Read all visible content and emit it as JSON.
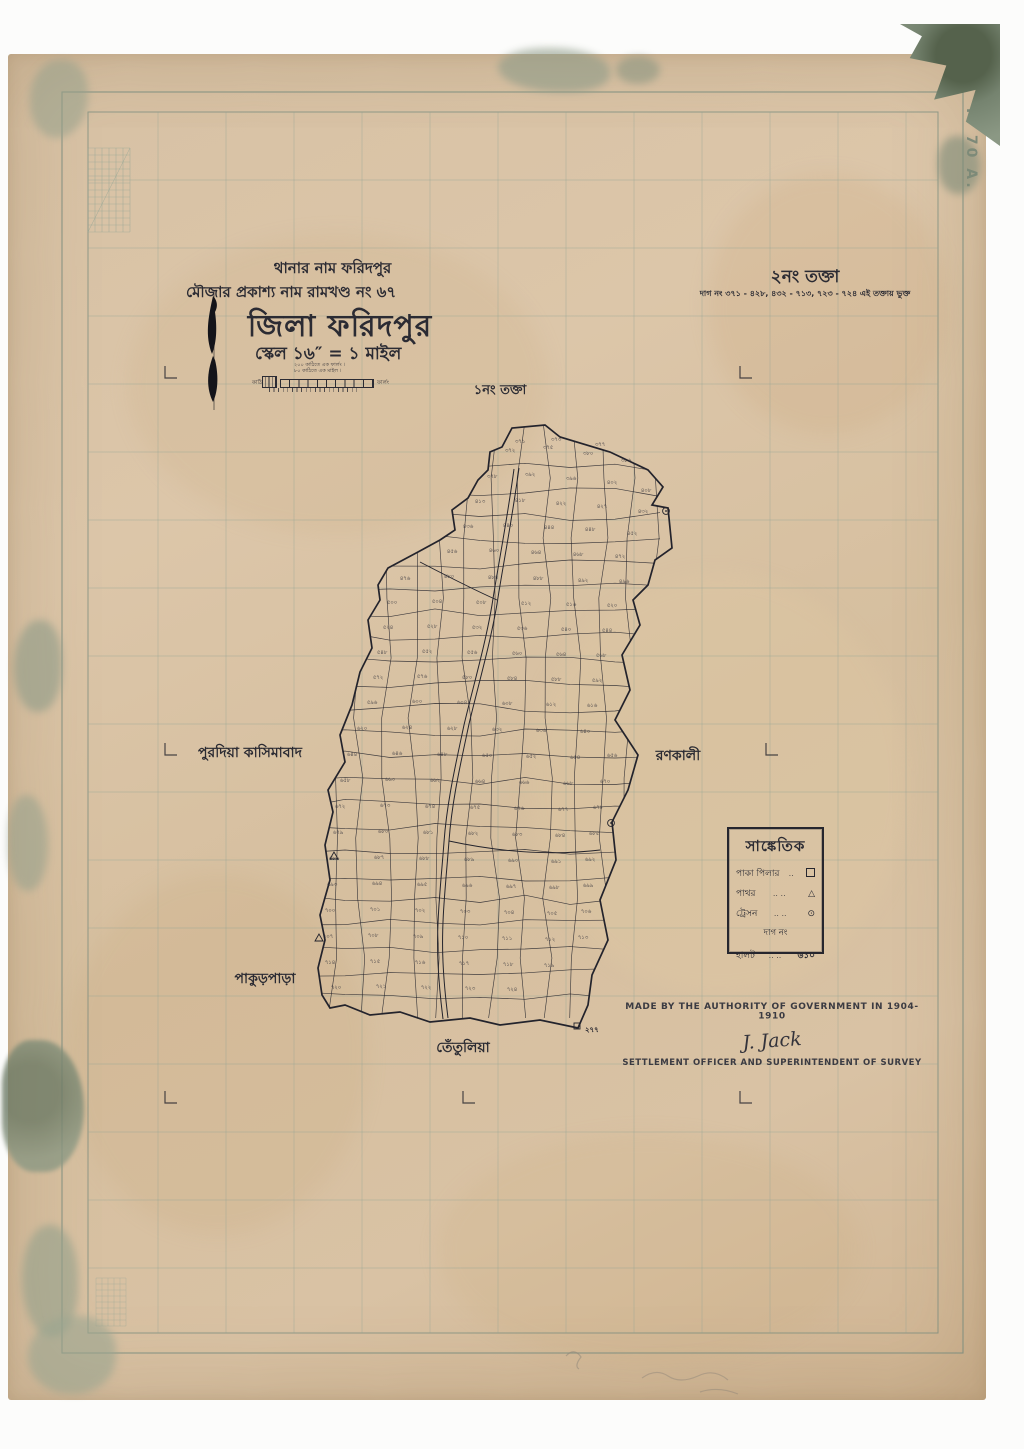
{
  "header": {
    "thana_line": "থানার নাম ফরিদপুর",
    "mouza_line": "মৌজার প্রকাশ্য নাম রামখণ্ড নং ৬৭",
    "district_title": "জিলা ফরিদপুর",
    "scale_line": "স্কেল ১৬″ = ১ মাইল",
    "scale_caption_1": "২০০ কাঠিতে এক ফার্লং ।",
    "scale_caption_2": "৮০ কাঠিতে এক মাইল ।",
    "scale_left_label": "কাঠি",
    "scale_right_label": "ফার্লং"
  },
  "sheet_refs": {
    "this_sheet_title": "২নং তক্তা",
    "this_sheet_plots": "দাগ নং ৩৭১ - ৪২৮, ৪৩২ - ৭১৩, ৭২৩ - ৭২৪ এই তক্তায় ভুক্ত",
    "adjacent_sheet_label": "১নং তক্তা",
    "page_ref": "P. 70 A."
  },
  "neighbors": {
    "west": "পুরদিয়া কাসিমাবাদ",
    "east": "রণকালী",
    "southwest": "পাকুড়পাড়া",
    "south": "তেঁতুলিয়া"
  },
  "legend": {
    "title": "সাঙ্কেতিক",
    "rows": [
      {
        "label": "পাকা পিলার",
        "dots": "..",
        "symbol": "pucca-pillar-square"
      },
      {
        "label": "পাথর",
        "dots": ".. ..",
        "symbol": "stone-triangle"
      },
      {
        "label": "ট্রেসন",
        "dots": ".. ..",
        "symbol": "traverse-station-circle"
      }
    ],
    "daag_heading": "দাগ নং",
    "halot_row": {
      "label": "হালট",
      "dots": ".. ..",
      "value": "৬১০"
    }
  },
  "credits": {
    "line1": "MADE BY THE AUTHORITY OF GOVERNMENT IN 1904-1910",
    "signature": "J. Jack",
    "line2": "SETTLEMENT OFFICER AND SUPERINTENDENT OF SURVEY"
  },
  "map": {
    "corner_plot": "২৭৭",
    "ink_color": "#23232c",
    "grid_color": "#8fa394",
    "plots": [
      [
        520,
        443,
        "৩৭১"
      ],
      [
        556,
        441,
        "৩৭৩"
      ],
      [
        600,
        446,
        "৩৭৭"
      ],
      [
        510,
        452,
        "৩৭২"
      ],
      [
        548,
        449,
        "৩৭৫"
      ],
      [
        588,
        455,
        "৩৮০"
      ],
      [
        626,
        462,
        "৩৮৬"
      ],
      [
        492,
        478,
        "৩৭৮"
      ],
      [
        530,
        476,
        "৩৯২"
      ],
      [
        571,
        480,
        "৩৯৬"
      ],
      [
        612,
        484,
        "৪০২"
      ],
      [
        646,
        492,
        "৪০৮"
      ],
      [
        480,
        503,
        "৪১৩"
      ],
      [
        520,
        502,
        "৪১৮"
      ],
      [
        561,
        505,
        "৪২২"
      ],
      [
        602,
        508,
        "৪২৭"
      ],
      [
        643,
        513,
        "৪৩২"
      ],
      [
        468,
        528,
        "৪৩৬"
      ],
      [
        508,
        527,
        "৪৪০"
      ],
      [
        549,
        529,
        "৪৪৪"
      ],
      [
        590,
        531,
        "৪৪৮"
      ],
      [
        632,
        535,
        "৪৫২"
      ],
      [
        452,
        553,
        "৪৫৬"
      ],
      [
        494,
        552,
        "৪৬০"
      ],
      [
        536,
        554,
        "৪৬৪"
      ],
      [
        578,
        556,
        "৪৬৮"
      ],
      [
        620,
        558,
        "৪৭২"
      ],
      [
        405,
        580,
        "৪৭৬"
      ],
      [
        449,
        578,
        "৪৮০"
      ],
      [
        493,
        579,
        "৪৮৪"
      ],
      [
        538,
        580,
        "৪৮৮"
      ],
      [
        583,
        582,
        "৪৯২"
      ],
      [
        624,
        583,
        "৪৯৬"
      ],
      [
        392,
        604,
        "৫০০"
      ],
      [
        437,
        603,
        "৫০৪"
      ],
      [
        481,
        604,
        "৫০৮"
      ],
      [
        526,
        605,
        "৫১২"
      ],
      [
        571,
        606,
        "৫১৬"
      ],
      [
        612,
        607,
        "৫২০"
      ],
      [
        388,
        629,
        "৫২৪"
      ],
      [
        432,
        628,
        "৫২৮"
      ],
      [
        477,
        629,
        "৫৩২"
      ],
      [
        522,
        630,
        "৫৩৬"
      ],
      [
        566,
        631,
        "৫৪০"
      ],
      [
        607,
        632,
        "৫৪৪"
      ],
      [
        382,
        654,
        "৫৪৮"
      ],
      [
        427,
        653,
        "৫৫২"
      ],
      [
        472,
        654,
        "৫৫৬"
      ],
      [
        517,
        655,
        "৫৬০"
      ],
      [
        561,
        656,
        "৫৬৪"
      ],
      [
        601,
        657,
        "৫৬৮"
      ],
      [
        378,
        679,
        "৫৭২"
      ],
      [
        422,
        678,
        "৫৭৬"
      ],
      [
        467,
        679,
        "৫৮০"
      ],
      [
        512,
        680,
        "৫৮৪"
      ],
      [
        556,
        681,
        "৫৮৮"
      ],
      [
        597,
        682,
        "৫৯২"
      ],
      [
        372,
        704,
        "৫৯৬"
      ],
      [
        417,
        703,
        "৬০০"
      ],
      [
        462,
        704,
        "৬০৪"
      ],
      [
        507,
        705,
        "৬০৮"
      ],
      [
        551,
        706,
        "৬১২"
      ],
      [
        592,
        707,
        "৬১৬"
      ],
      [
        362,
        730,
        "৬২০"
      ],
      [
        407,
        729,
        "৬২৪"
      ],
      [
        452,
        730,
        "৬২৮"
      ],
      [
        497,
        731,
        "৬৩২"
      ],
      [
        541,
        732,
        "৬৩৬"
      ],
      [
        585,
        733,
        "৬৪০"
      ],
      [
        352,
        756,
        "৬৪৪"
      ],
      [
        397,
        755,
        "৬৪৬"
      ],
      [
        442,
        756,
        "৬৪৮"
      ],
      [
        487,
        757,
        "৬৫০"
      ],
      [
        531,
        758,
        "৬৫২"
      ],
      [
        575,
        759,
        "৬৫৪"
      ],
      [
        612,
        757,
        "৬৫৬"
      ],
      [
        345,
        782,
        "৬৫৮"
      ],
      [
        390,
        781,
        "৬৬০"
      ],
      [
        435,
        782,
        "৬৬২"
      ],
      [
        480,
        783,
        "৬৬৪"
      ],
      [
        524,
        784,
        "৬৬৬"
      ],
      [
        568,
        785,
        "৬৬৮"
      ],
      [
        605,
        783,
        "৬৭০"
      ],
      [
        340,
        808,
        "৬৭২"
      ],
      [
        385,
        807,
        "৬৭৩"
      ],
      [
        430,
        808,
        "৬৭৪"
      ],
      [
        475,
        809,
        "৬৭৫"
      ],
      [
        519,
        810,
        "৬৭৬"
      ],
      [
        563,
        811,
        "৬৭৭"
      ],
      [
        598,
        809,
        "৬৭৮"
      ],
      [
        338,
        834,
        "৬৭৯"
      ],
      [
        383,
        833,
        "৬৮০"
      ],
      [
        428,
        834,
        "৬৮১"
      ],
      [
        473,
        835,
        "৬৮২"
      ],
      [
        517,
        836,
        "৬৮৩"
      ],
      [
        560,
        837,
        "৬৮৪"
      ],
      [
        594,
        835,
        "৬৮৫"
      ],
      [
        334,
        860,
        "৬৮৬"
      ],
      [
        379,
        859,
        "৬৮৭"
      ],
      [
        424,
        860,
        "৬৮৮"
      ],
      [
        469,
        861,
        "৬৮৯"
      ],
      [
        513,
        862,
        "৬৯০"
      ],
      [
        556,
        863,
        "৬৯১"
      ],
      [
        590,
        861,
        "৬৯২"
      ],
      [
        332,
        886,
        "৬৯৩"
      ],
      [
        377,
        885,
        "৬৯৪"
      ],
      [
        422,
        886,
        "৬৯৫"
      ],
      [
        467,
        887,
        "৬৯৬"
      ],
      [
        511,
        888,
        "৬৯৭"
      ],
      [
        554,
        889,
        "৬৯৮"
      ],
      [
        588,
        887,
        "৬৯৯"
      ],
      [
        330,
        912,
        "৭০০"
      ],
      [
        375,
        911,
        "৭০১"
      ],
      [
        420,
        912,
        "৭০২"
      ],
      [
        465,
        913,
        "৭০৩"
      ],
      [
        509,
        914,
        "৭০৪"
      ],
      [
        552,
        915,
        "৭০৫"
      ],
      [
        586,
        913,
        "৭০৬"
      ],
      [
        328,
        938,
        "৭০৭"
      ],
      [
        373,
        937,
        "৭০৮"
      ],
      [
        418,
        938,
        "৭০৯"
      ],
      [
        463,
        939,
        "৭১০"
      ],
      [
        507,
        940,
        "৭১১"
      ],
      [
        550,
        941,
        "৭১২"
      ],
      [
        583,
        939,
        "৭১৩"
      ],
      [
        330,
        964,
        "৭১৪"
      ],
      [
        375,
        963,
        "৭১৫"
      ],
      [
        420,
        964,
        "৭১৬"
      ],
      [
        464,
        965,
        "৭১৭"
      ],
      [
        508,
        966,
        "৭১৮"
      ],
      [
        549,
        967,
        "৭১৯"
      ],
      [
        336,
        989,
        "৭২০"
      ],
      [
        381,
        988,
        "৭২১"
      ],
      [
        426,
        989,
        "৭২২"
      ],
      [
        470,
        990,
        "৭২৩"
      ],
      [
        512,
        991,
        "৭২৪"
      ]
    ]
  }
}
